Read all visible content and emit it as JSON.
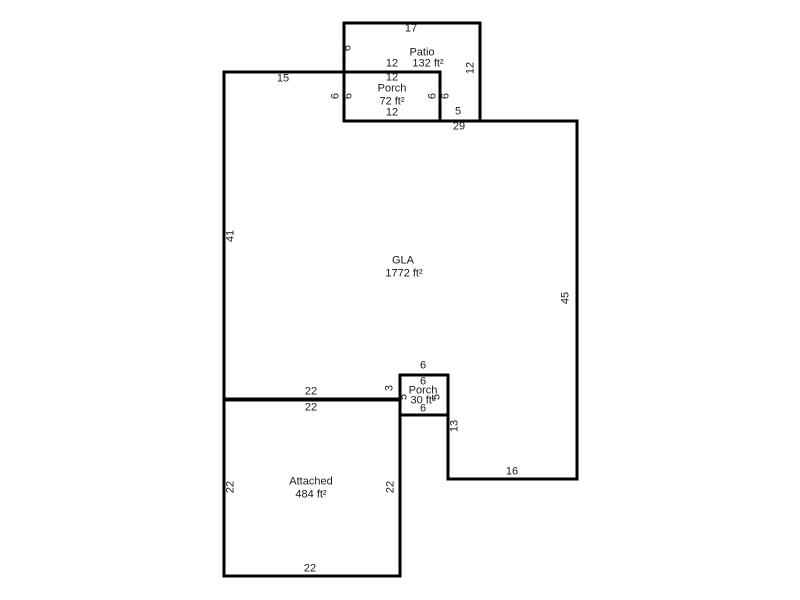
{
  "floorplan": {
    "rooms": {
      "patio": {
        "name": "Patio",
        "area": "132 ft²"
      },
      "upper_porch": {
        "name": "Porch",
        "area": "72 ft²"
      },
      "gla": {
        "name": "GLA",
        "area": "1772 ft²"
      },
      "lower_porch": {
        "name": "Porch",
        "area": "30 ft²"
      },
      "attached": {
        "name": "Attached",
        "area": "484 ft²"
      }
    },
    "dimensions": {
      "patio_top": "17",
      "patio_left": "6",
      "patio_right": "12",
      "patio_bottom_inner": "12",
      "patio_step": "5",
      "upper_porch_top": "12",
      "upper_porch_bottom": "12",
      "upper_porch_left_outer": "6",
      "upper_porch_left_inner": "6",
      "upper_porch_right_inner": "6",
      "upper_porch_right_outer": "6",
      "gla_top_left": "15",
      "gla_top_right": "29",
      "gla_left": "41",
      "gla_right": "45",
      "gla_bottom_left": "22",
      "gla_step": "3",
      "gla_right_step": "13",
      "gla_bottom_right": "16",
      "lower_porch_top_outer": "6",
      "lower_porch_top_inner": "6",
      "lower_porch_left": "5",
      "lower_porch_right": "5",
      "lower_porch_bottom": "6",
      "garage_top": "22",
      "garage_left": "22",
      "garage_right": "22",
      "garage_bottom": "22"
    },
    "colors": {
      "wall": "#000000",
      "text": "#1a1a1a",
      "background": "#ffffff"
    }
  }
}
